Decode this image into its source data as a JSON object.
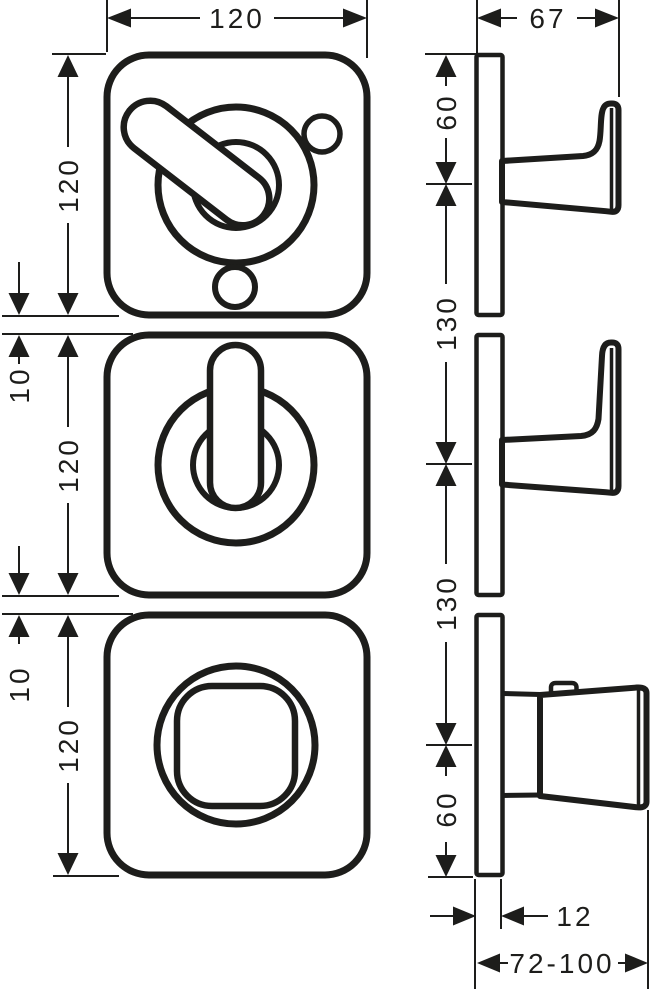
{
  "drawing": {
    "type": "technical-dimension-drawing",
    "colors": {
      "line": "#1d1d1b",
      "background": "#ffffff"
    },
    "front_view": {
      "width_label": "120",
      "plate_height_labels": [
        "120",
        "120",
        "120"
      ],
      "gap_labels": [
        "10",
        "10"
      ]
    },
    "side_view": {
      "depth_label": "67",
      "offset_top_label": "60",
      "spacing_labels": [
        "130",
        "130"
      ],
      "offset_bottom_label": "60",
      "plate_thickness_label": "12",
      "installation_depth_label": "72-100"
    }
  }
}
